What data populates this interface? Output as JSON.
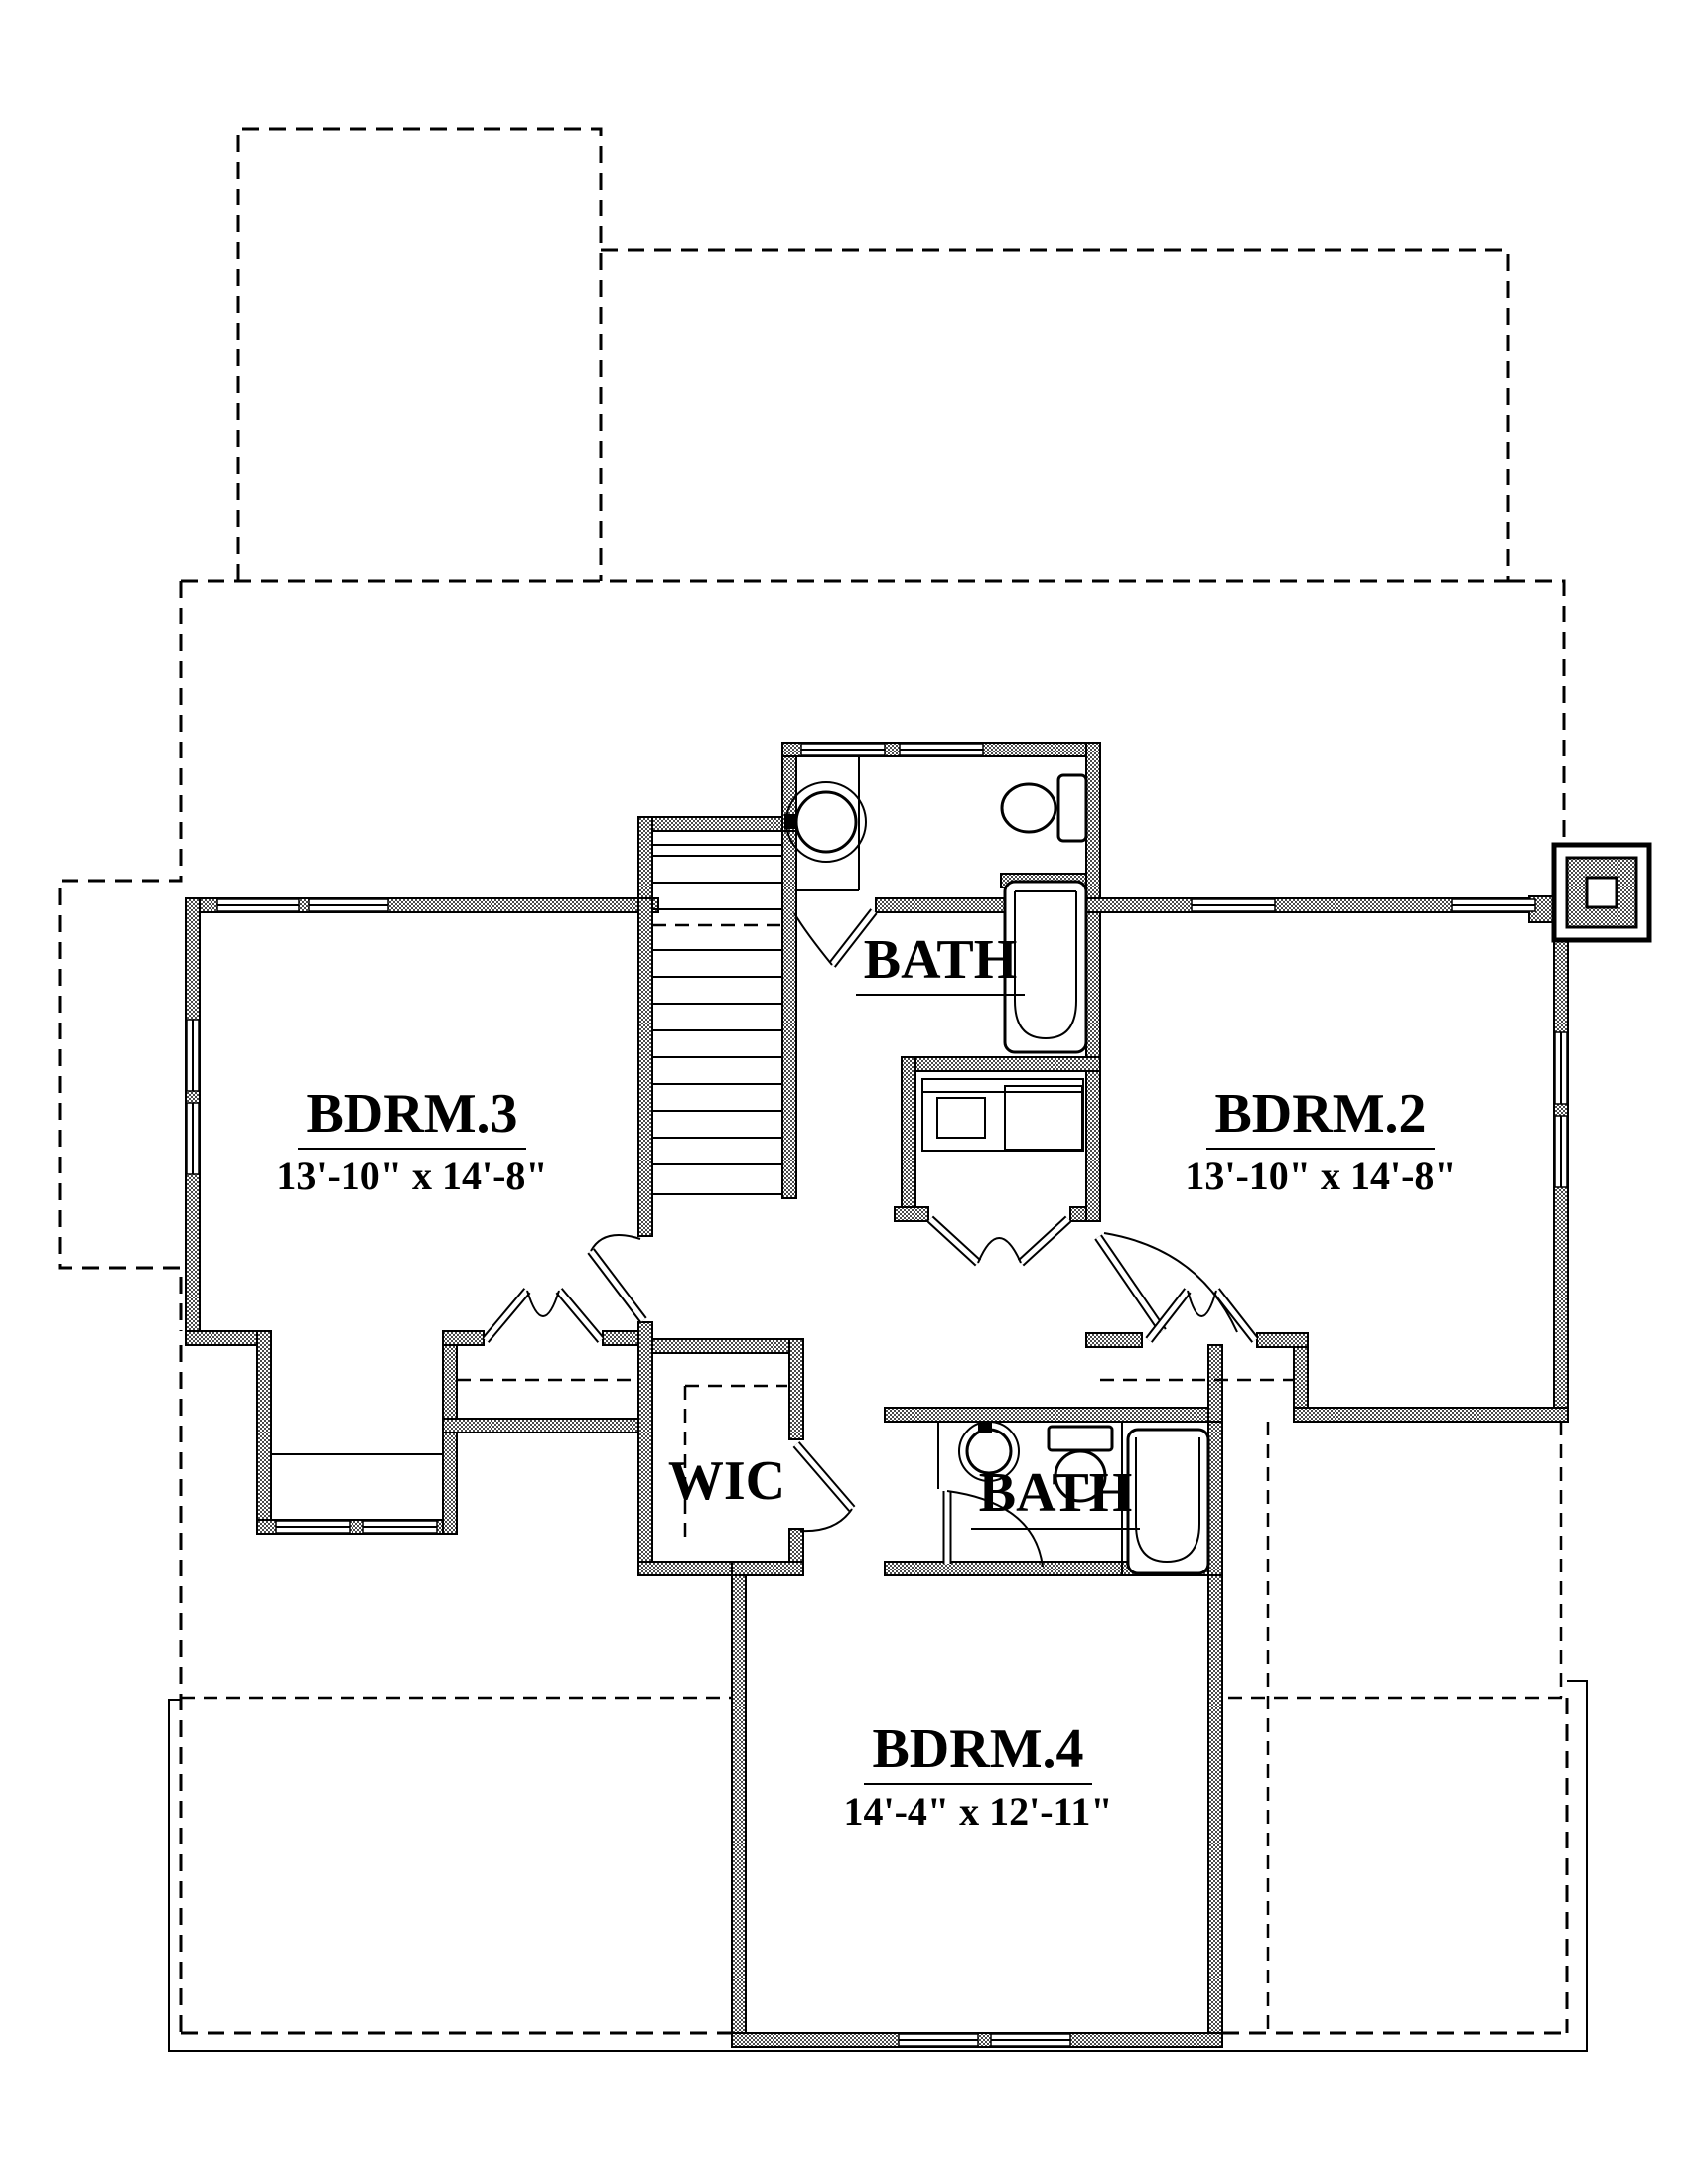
{
  "plan": {
    "rooms": [
      {
        "id": "bath-upper",
        "label": "BATH",
        "dims": ""
      },
      {
        "id": "bdrm3",
        "label": "BDRM.3",
        "dims": "13'-10\" x 14'-8\""
      },
      {
        "id": "bdrm2",
        "label": "BDRM.2",
        "dims": "13'-10\" x 14'-8\""
      },
      {
        "id": "wic",
        "label": "WIC",
        "dims": ""
      },
      {
        "id": "bath-lower",
        "label": "BATH",
        "dims": ""
      },
      {
        "id": "bdrm4",
        "label": "BDRM.4",
        "dims": "14'-4\" x 12'-11\""
      }
    ],
    "colors": {
      "line": "#000000",
      "background": "#ffffff"
    }
  }
}
